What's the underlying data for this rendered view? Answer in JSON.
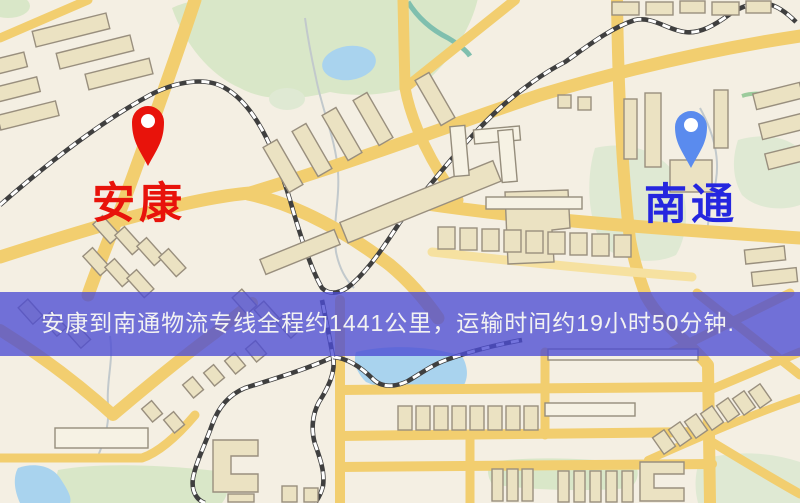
{
  "page": {
    "type": "logistics-route-map"
  },
  "markers": {
    "origin": {
      "label": "安康",
      "pin_color": "#E8130B",
      "label_color": "#E8130B"
    },
    "destination": {
      "label": "南通",
      "pin_color": "#5A8BEE",
      "label_color": "#2526DF"
    }
  },
  "banner": {
    "text": "安康到南通物流专线全程约1441公里，运输时间约19小时50分钟.",
    "bg_color": "#4C4CD4",
    "text_color": "#F2F2F2",
    "route": {
      "origin": "安康",
      "destination": "南通",
      "service": "物流专线",
      "distance_km": "1441",
      "duration_hours": "19",
      "duration_minutes": "50"
    }
  },
  "map": {
    "colors": {
      "background": "#F4EFE3",
      "road_major": "#F2CE6F",
      "park": "#D9E7C8",
      "water": "#A9D3EE",
      "railway": "#3F3F3F",
      "building_fill": "#EBE2C2",
      "building_stroke": "#998F7E"
    }
  }
}
